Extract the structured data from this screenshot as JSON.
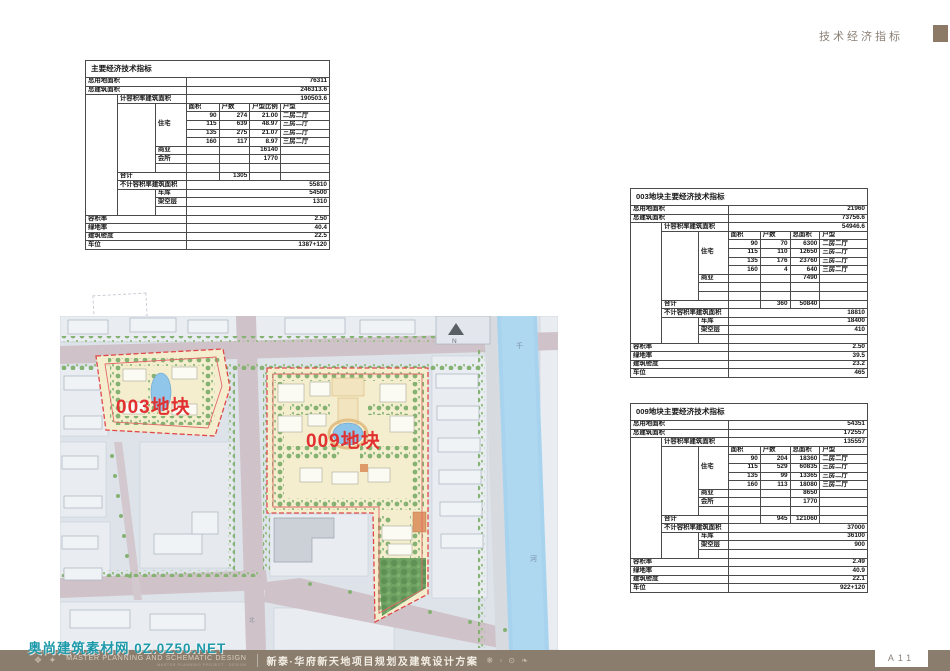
{
  "header": {
    "section_label": "技术经济指标"
  },
  "page": {
    "page_number": "A11"
  },
  "footer": {
    "marks": "❖ ✦",
    "brand_main": "MASTER PLANNING AND SCHEMATIC DESIGN",
    "brand_sub": "MASTER PLANNING PROJECT · DESIGN",
    "project_title": "新泰·华府新天地项目规划及建筑设计方案",
    "ornaments": "❋ ◦ ⊙ ❧",
    "watermark": "奥尚建筑素材网 0Z.0Z50.NET"
  },
  "map": {
    "plot_labels": {
      "plot003": "003地块",
      "plot009": "009地块"
    },
    "north_label": "N",
    "river_char_top": "千",
    "river_char_bottom": "河",
    "road_char": "北"
  },
  "colors": {
    "footer_bar": "#8b7d6e",
    "header_square": "#8c7a66",
    "plot_outline_red": "#e04848",
    "plot_label_red": "#e22f2f",
    "watermark_teal": "#1f9aaa",
    "river_blue": "#a8d3ee",
    "road_mauve": "#cfc2c8",
    "plot_cream": "#f4eecf"
  },
  "tables": {
    "main": {
      "title": "主要经济技术指标",
      "rows": [
        [
          {
            "t": "总用地面积",
            "c": 3
          },
          {
            "t": "76311",
            "c": 4,
            "a": "r"
          }
        ],
        [
          {
            "t": "总建筑面积",
            "c": 3
          },
          {
            "t": "246313.6",
            "c": 4,
            "a": "r"
          }
        ],
        [
          {
            "t": "",
            "r": 14
          },
          {
            "t": "计容积率建筑面积",
            "c": 2
          },
          {
            "t": "190503.6",
            "c": 4,
            "a": "r"
          }
        ],
        [
          {
            "t": "",
            "r": 8
          },
          {
            "t": "住宅",
            "r": 5
          },
          {
            "t": "面积"
          },
          {
            "t": "户数"
          },
          {
            "t": "户型比例"
          },
          {
            "t": "户型"
          }
        ],
        [
          {
            "t": "90",
            "a": "r"
          },
          {
            "t": "274",
            "a": "r"
          },
          {
            "t": "21.00",
            "a": "r"
          },
          {
            "t": "二房二厅"
          }
        ],
        [
          {
            "t": "115",
            "a": "r"
          },
          {
            "t": "639",
            "a": "r"
          },
          {
            "t": "48.97",
            "a": "r"
          },
          {
            "t": "三房二厅"
          }
        ],
        [
          {
            "t": "135",
            "a": "r"
          },
          {
            "t": "275",
            "a": "r"
          },
          {
            "t": "21.07",
            "a": "r"
          },
          {
            "t": "三房二厅"
          }
        ],
        [
          {
            "t": "160",
            "a": "r"
          },
          {
            "t": "117",
            "a": "r"
          },
          {
            "t": "8.97",
            "a": "r"
          },
          {
            "t": "三房二厅"
          }
        ],
        [
          {
            "t": "商业"
          },
          {
            "t": ""
          },
          {
            "t": ""
          },
          {
            "t": "16140",
            "a": "r"
          },
          {
            "t": ""
          }
        ],
        [
          {
            "t": "会所"
          },
          {
            "t": ""
          },
          {
            "t": ""
          },
          {
            "t": "1770",
            "a": "r"
          },
          {
            "t": ""
          }
        ],
        [
          {
            "t": ""
          },
          {
            "t": ""
          },
          {
            "t": ""
          },
          {
            "t": ""
          },
          {
            "t": ""
          }
        ],
        [
          {
            "t": "合计",
            "c": 2
          },
          {
            "t": ""
          },
          {
            "t": "1305",
            "a": "r"
          },
          {
            "t": ""
          },
          {
            "t": ""
          }
        ],
        [
          {
            "t": "不计容积率建筑面积",
            "c": 2
          },
          {
            "t": "55810",
            "c": 4,
            "a": "r"
          }
        ],
        [
          {
            "t": "",
            "r": 3
          },
          {
            "t": "车库"
          },
          {
            "t": "54500",
            "c": 4,
            "a": "r"
          }
        ],
        [
          {
            "t": "架空层"
          },
          {
            "t": "1310",
            "c": 4,
            "a": "r"
          }
        ],
        [
          {
            "t": ""
          },
          {
            "t": "",
            "c": 4
          }
        ],
        [
          {
            "t": "容积率",
            "c": 3
          },
          {
            "t": "2.50",
            "c": 4,
            "a": "r"
          }
        ],
        [
          {
            "t": "绿地率",
            "c": 3
          },
          {
            "t": "40.4",
            "c": 4,
            "a": "r"
          }
        ],
        [
          {
            "t": "建筑密度",
            "c": 3
          },
          {
            "t": "22.5",
            "c": 4,
            "a": "r"
          }
        ],
        [
          {
            "t": "车位",
            "c": 3
          },
          {
            "t": "1387+120",
            "c": 4,
            "a": "r"
          }
        ]
      ]
    },
    "plot003": {
      "title": "003地块主要经济技术指标",
      "rows": [
        [
          {
            "t": "总用地面积",
            "c": 3
          },
          {
            "t": "21960",
            "c": 4,
            "a": "r"
          }
        ],
        [
          {
            "t": "总建筑面积",
            "c": 3
          },
          {
            "t": "73756.6",
            "c": 4,
            "a": "r"
          }
        ],
        [
          {
            "t": "",
            "r": 14
          },
          {
            "t": "计容积率建筑面积",
            "c": 2
          },
          {
            "t": "54946.6",
            "c": 4,
            "a": "r"
          }
        ],
        [
          {
            "t": "",
            "r": 8
          },
          {
            "t": "住宅",
            "r": 5
          },
          {
            "t": "面积"
          },
          {
            "t": "户数"
          },
          {
            "t": "总面积"
          },
          {
            "t": "户型"
          }
        ],
        [
          {
            "t": "90",
            "a": "r"
          },
          {
            "t": "70",
            "a": "r"
          },
          {
            "t": "6300",
            "a": "r"
          },
          {
            "t": "二房二厅"
          }
        ],
        [
          {
            "t": "115",
            "a": "r"
          },
          {
            "t": "110",
            "a": "r"
          },
          {
            "t": "12650",
            "a": "r"
          },
          {
            "t": "三房二厅"
          }
        ],
        [
          {
            "t": "135",
            "a": "r"
          },
          {
            "t": "176",
            "a": "r"
          },
          {
            "t": "23760",
            "a": "r"
          },
          {
            "t": "三房二厅"
          }
        ],
        [
          {
            "t": "160",
            "a": "r"
          },
          {
            "t": "4",
            "a": "r"
          },
          {
            "t": "640",
            "a": "r"
          },
          {
            "t": "三房二厅"
          }
        ],
        [
          {
            "t": "商业"
          },
          {
            "t": ""
          },
          {
            "t": ""
          },
          {
            "t": "7490",
            "a": "r"
          },
          {
            "t": ""
          }
        ],
        [
          {
            "t": ""
          },
          {
            "t": ""
          },
          {
            "t": ""
          },
          {
            "t": ""
          },
          {
            "t": ""
          }
        ],
        [
          {
            "t": ""
          },
          {
            "t": ""
          },
          {
            "t": ""
          },
          {
            "t": ""
          },
          {
            "t": ""
          }
        ],
        [
          {
            "t": "合计",
            "c": 2
          },
          {
            "t": ""
          },
          {
            "t": "360",
            "a": "r"
          },
          {
            "t": "50840",
            "a": "r"
          },
          {
            "t": ""
          }
        ],
        [
          {
            "t": "不计容积率建筑面积",
            "c": 2
          },
          {
            "t": "18810",
            "c": 4,
            "a": "r"
          }
        ],
        [
          {
            "t": "",
            "r": 3
          },
          {
            "t": "车库"
          },
          {
            "t": "18400",
            "c": 4,
            "a": "r"
          }
        ],
        [
          {
            "t": "架空层"
          },
          {
            "t": "410",
            "c": 4,
            "a": "r"
          }
        ],
        [
          {
            "t": ""
          },
          {
            "t": "",
            "c": 4
          }
        ],
        [
          {
            "t": "容积率",
            "c": 3
          },
          {
            "t": "2.50",
            "c": 4,
            "a": "r"
          }
        ],
        [
          {
            "t": "绿地率",
            "c": 3
          },
          {
            "t": "39.5",
            "c": 4,
            "a": "r"
          }
        ],
        [
          {
            "t": "建筑密度",
            "c": 3
          },
          {
            "t": "23.2",
            "c": 4,
            "a": "r"
          }
        ],
        [
          {
            "t": "车位",
            "c": 3
          },
          {
            "t": "465",
            "c": 4,
            "a": "r"
          }
        ]
      ]
    },
    "plot009": {
      "title": "009地块主要经济技术指标",
      "rows": [
        [
          {
            "t": "总用地面积",
            "c": 3
          },
          {
            "t": "54351",
            "c": 4,
            "a": "r"
          }
        ],
        [
          {
            "t": "总建筑面积",
            "c": 3
          },
          {
            "t": "172557",
            "c": 4,
            "a": "r"
          }
        ],
        [
          {
            "t": "",
            "r": 14
          },
          {
            "t": "计容积率建筑面积",
            "c": 2
          },
          {
            "t": "135557",
            "c": 4,
            "a": "r"
          }
        ],
        [
          {
            "t": "",
            "r": 8
          },
          {
            "t": "住宅",
            "r": 5
          },
          {
            "t": "面积"
          },
          {
            "t": "户数"
          },
          {
            "t": "总面积"
          },
          {
            "t": "户型"
          }
        ],
        [
          {
            "t": "90",
            "a": "r"
          },
          {
            "t": "204",
            "a": "r"
          },
          {
            "t": "18360",
            "a": "r"
          },
          {
            "t": "二房二厅"
          }
        ],
        [
          {
            "t": "115",
            "a": "r"
          },
          {
            "t": "529",
            "a": "r"
          },
          {
            "t": "60835",
            "a": "r"
          },
          {
            "t": "三房二厅"
          }
        ],
        [
          {
            "t": "135",
            "a": "r"
          },
          {
            "t": "99",
            "a": "r"
          },
          {
            "t": "13365",
            "a": "r"
          },
          {
            "t": "三房二厅"
          }
        ],
        [
          {
            "t": "160",
            "a": "r"
          },
          {
            "t": "113",
            "a": "r"
          },
          {
            "t": "18080",
            "a": "r"
          },
          {
            "t": "三房二厅"
          }
        ],
        [
          {
            "t": "商业"
          },
          {
            "t": ""
          },
          {
            "t": ""
          },
          {
            "t": "8650",
            "a": "r"
          },
          {
            "t": ""
          }
        ],
        [
          {
            "t": "会所"
          },
          {
            "t": ""
          },
          {
            "t": ""
          },
          {
            "t": "1770",
            "a": "r"
          },
          {
            "t": ""
          }
        ],
        [
          {
            "t": ""
          },
          {
            "t": ""
          },
          {
            "t": ""
          },
          {
            "t": ""
          },
          {
            "t": ""
          }
        ],
        [
          {
            "t": "合计",
            "c": 2
          },
          {
            "t": ""
          },
          {
            "t": "945",
            "a": "r"
          },
          {
            "t": "121060",
            "a": "r"
          },
          {
            "t": ""
          }
        ],
        [
          {
            "t": "不计容积率建筑面积",
            "c": 2
          },
          {
            "t": "37000",
            "c": 4,
            "a": "r"
          }
        ],
        [
          {
            "t": "",
            "r": 3
          },
          {
            "t": "车库"
          },
          {
            "t": "36100",
            "c": 4,
            "a": "r"
          }
        ],
        [
          {
            "t": "架空层"
          },
          {
            "t": "900",
            "c": 4,
            "a": "r"
          }
        ],
        [
          {
            "t": ""
          },
          {
            "t": "",
            "c": 4
          }
        ],
        [
          {
            "t": "容积率",
            "c": 3
          },
          {
            "t": "2.49",
            "c": 4,
            "a": "r"
          }
        ],
        [
          {
            "t": "绿地率",
            "c": 3
          },
          {
            "t": "40.9",
            "c": 4,
            "a": "r"
          }
        ],
        [
          {
            "t": "建筑密度",
            "c": 3
          },
          {
            "t": "22.1",
            "c": 4,
            "a": "r"
          }
        ],
        [
          {
            "t": "车位",
            "c": 3
          },
          {
            "t": "922+120",
            "c": 4,
            "a": "r"
          }
        ]
      ]
    }
  }
}
